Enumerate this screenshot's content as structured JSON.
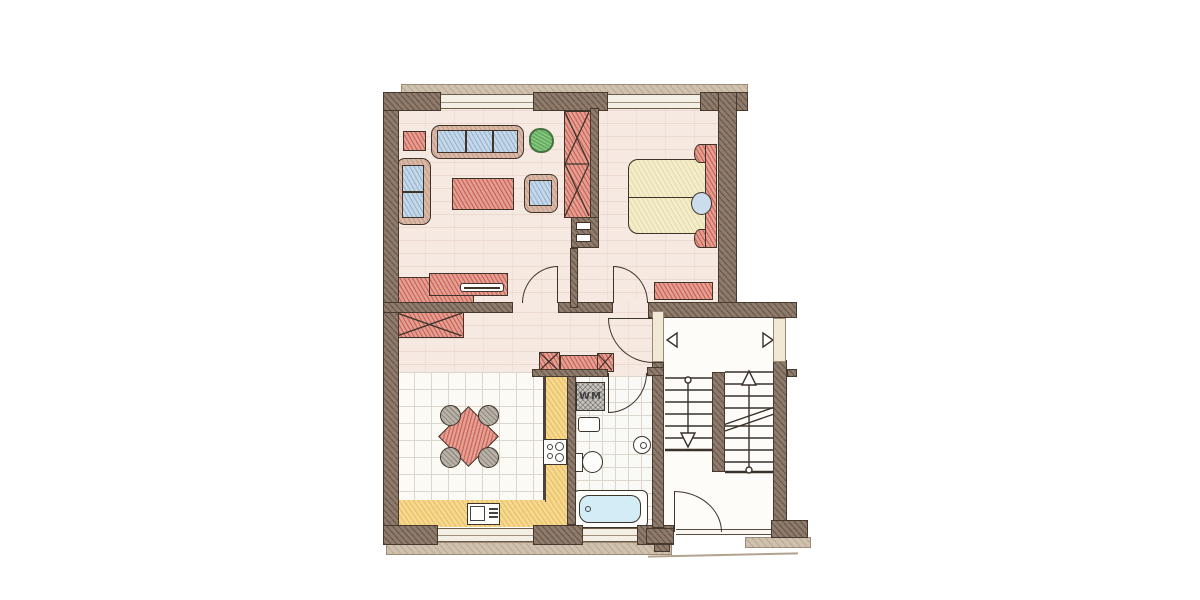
{
  "labels": {
    "washing_machine": "WM"
  },
  "colors": {
    "wall": "#8f7b6b",
    "wall_stroke": "#46392d",
    "outline": "#3e342a",
    "floor": "#f6e9e1",
    "coping": "#cfc1ae",
    "pillar": "#f1e9d6",
    "red": "#e5a093",
    "tan": "#d9b8a7",
    "blue": "#c5d8e9",
    "cream": "#f4edca",
    "yellow": "#f6d88e",
    "tub": "#d3ecf5",
    "green": "#83c67c",
    "gray": "#c9c5be",
    "chair_gray": "#b9b3a9",
    "tile_line": "#dcd6cc",
    "white_floor": "#fdfcf8"
  }
}
